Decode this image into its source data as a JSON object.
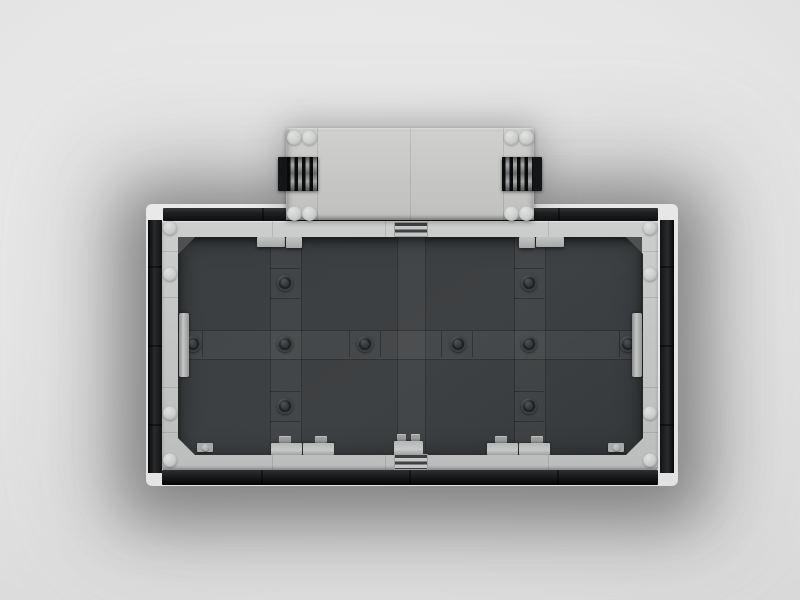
{
  "scene": {
    "description": "Photorealistic top-down 3D render of a rectangular LEGO-style display tray: black outer rails, a light-gray studded plate frame, a dark-gray tiled interior floor, and a light-gray hinged box attached at the top center with black side grilles.",
    "background": {
      "center_color": "#ececec",
      "edge_color": "#d2d2d2",
      "shadow_color": "rgba(70,70,70,0.5)"
    }
  },
  "palette": {
    "light_gray_plate": "#c8c9c7",
    "light_gray_highlight": "#e0e1df",
    "light_gray_shadow": "#a8aaa9",
    "frame_gray": "#c3c5c5",
    "interior_floor": "#3b3e40",
    "interior_tile": "#44474a",
    "rail_black": "#17181a",
    "grille_black": "#0c0d0e",
    "grille_bar_gray": "#a6a8a8",
    "dark_stud": "#303335"
  },
  "model": {
    "hinge_box": {
      "corner_studs": 8,
      "side_grilles": 2,
      "panel_seams": 3,
      "color": "#c8c9c7"
    },
    "frame": {
      "edge_studs": 8,
      "grille_tiles": 2,
      "color": "#c3c5c5"
    },
    "interior": {
      "dark_studs": 10,
      "edge_clips": 2,
      "bottom_hinge_pieces": 5,
      "top_plates": 4,
      "chamfered_corners": 4,
      "color": "#3b3e40"
    },
    "rails": {
      "count": 4,
      "color": "#17181a"
    }
  }
}
